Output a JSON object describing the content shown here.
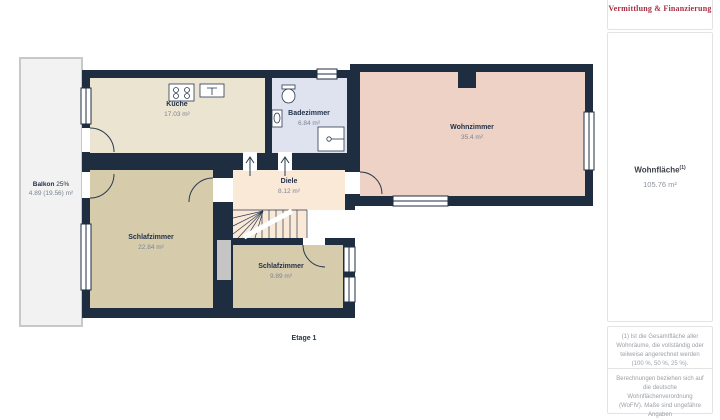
{
  "plan": {
    "rooms": [
      {
        "name": "Küche",
        "area": "17.03 m²"
      },
      {
        "name": "Badezimmer",
        "area": "6.84 m²"
      },
      {
        "name": "Wohnzimmer",
        "area": "35.4 m²"
      },
      {
        "name": "Diele",
        "area": "8.12 m²"
      },
      {
        "name": "Schlafzimmer",
        "area": "22.84 m²"
      },
      {
        "name": "Schlafzimmer",
        "area": "9.89 m²"
      }
    ],
    "balcony": {
      "name": "Balkon",
      "percent": "25%",
      "area": "4.89 (19.56) m²"
    },
    "floor_label": "Etage 1",
    "colors": {
      "wall": "#1f2d40",
      "kueche": "#ebe4d0",
      "badezimmer": "#dee3ef",
      "wohnzimmer": "#edd2c5",
      "diele": "#fbe9d8",
      "schlafzimmer": "#d6ccac",
      "balkon": "#f2f2f2",
      "brand_red": "#a83044"
    }
  },
  "sidebar": {
    "brand": "Vermittlung & Finanzierung",
    "living_area_label": "Wohnfläche",
    "living_area_sup": "(1)",
    "living_area_value": "105.76 m²",
    "footnote1": "(1) Ist die Gesamtfläche aller Wohnräume, die vollständig oder teilweise angerechnet werden (100 %, 50 %, 25 %).",
    "footnote2": "Berechnungen beziehen sich auf die deutsche Wohnflächenverordnung (WoFlV). Maße sind ungefähre Angaben"
  }
}
